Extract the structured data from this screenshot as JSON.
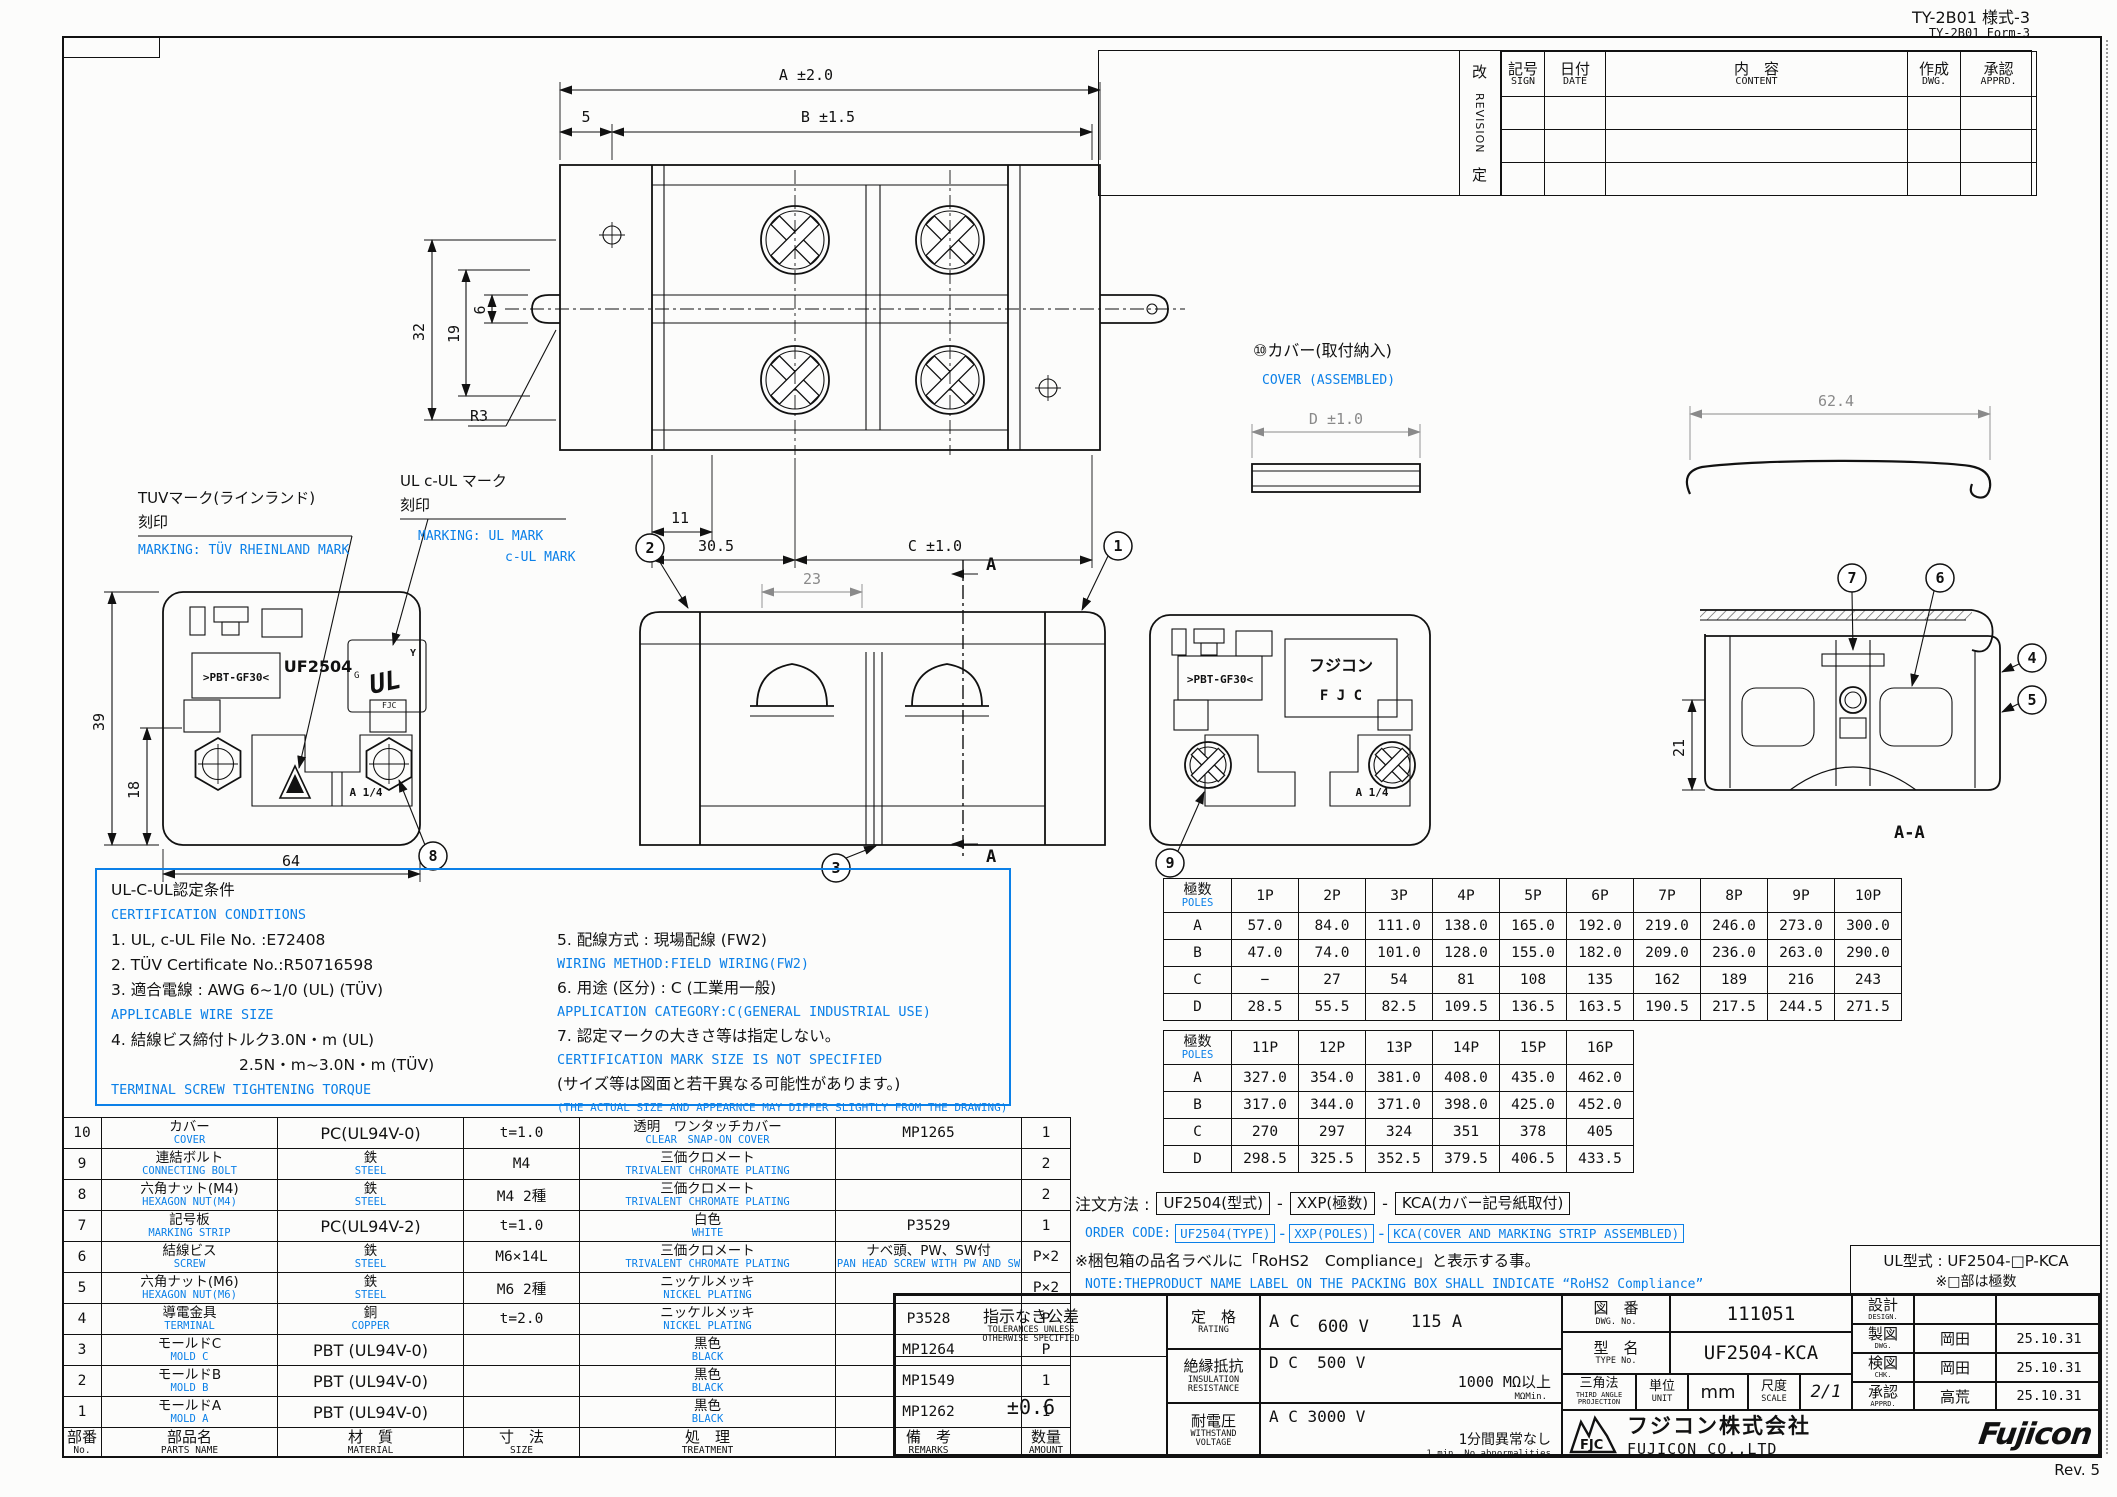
{
  "page": {
    "form_jp": "TY-2B01 様式-3",
    "form_en": "TY-2B01 Form-3",
    "rev": "Rev. 5"
  },
  "revision_table": {
    "side_top": "改",
    "side_mid": "REVISION",
    "side_bottom": "定",
    "cols": [
      {
        "jp": "記号",
        "en": "SIGN"
      },
      {
        "jp": "日付",
        "en": "DATE"
      },
      {
        "jp": "内　容",
        "en": "CONTENT"
      },
      {
        "jp": "作成",
        "en": "DWG."
      },
      {
        "jp": "承認",
        "en": "APPRD."
      }
    ],
    "empty_rows": 3
  },
  "drawing": {
    "dims": {
      "A": "A ±2.0",
      "B": "B ±1.5",
      "d5": "5",
      "d32": "32",
      "d19": "19",
      "d6": "6",
      "r3": "R3",
      "d11": "11",
      "d305": "30.5",
      "C": "C ±1.0",
      "d23": "23",
      "d39": "39",
      "d18": "18",
      "d64": "64",
      "D": "D ±1.0",
      "d624": "62.4",
      "d21": "21"
    },
    "balloons": {
      "b1": "1",
      "b2": "2",
      "b3": "3",
      "b4": "4",
      "b5": "5",
      "b6": "6",
      "b7": "7",
      "b8": "8",
      "b9": "9"
    },
    "section_arrow": "A",
    "section_label": "A-A",
    "marks": {
      "uf": "UF2504",
      "pbt": ">PBT-GF30<",
      "a14": "A 1/4",
      "brand_jp": "フジコン",
      "brand_en": "F J C",
      "ul": "UL",
      "ul_y": "Y",
      "ul_g": "G",
      "ul_fjc": "FJC"
    },
    "labels": {
      "tuv_jp1": "TUVマーク(ラインランド)",
      "tuv_jp2": "刻印",
      "tuv_en": "MARKING: TÜV RHEINLAND MARK",
      "ul_jp1": "UL c-UL マーク",
      "ul_jp2": "刻印",
      "ul_en1": "MARKING:    UL MARK",
      "ul_en2": "c-UL MARK",
      "cover_jp": "⑩カバー(取付納入)",
      "cover_en": "COVER (ASSEMBLED)"
    }
  },
  "cert_box": {
    "title": "UL-C-UL認定条件",
    "left": [
      {
        "t": "CERTIFICATION CONDITIONS",
        "blue": true
      },
      {
        "t": "1. UL, c-UL File No.   :E72408"
      },
      {
        "t": "2. TÜV Certificate No.:R50716598"
      },
      {
        "t": "3. 適合電線 : AWG  6~1/0 (UL)  (TÜV)"
      },
      {
        "t": "APPLICABLE WIRE SIZE",
        "blue": true
      },
      {
        "t": "4. 結線ビス締付トルク3.0N・m (UL)"
      },
      {
        "t": "2.5N・m~3.0N・m (TÜV)",
        "indent": true
      },
      {
        "t": "TERMINAL SCREW TIGHTENING TORQUE",
        "blue": true
      }
    ],
    "right": [
      {
        "t": "5. 配線方式 : 現場配線 (FW2)"
      },
      {
        "t": "WIRING METHOD:FIELD WIRING(FW2)",
        "blue": true
      },
      {
        "t": "6. 用途 (区分) : C (工業用一般)"
      },
      {
        "t": "APPLICATION CATEGORY:C(GENERAL INDUSTRIAL USE)",
        "blue": true
      },
      {
        "t": "7. 認定マークの大きさ等は指定しない。"
      },
      {
        "t": "CERTIFICATION MARK SIZE IS NOT SPECIFIED",
        "blue": true
      },
      {
        "t": "(サイズ等は図面と若干異なる可能性があります。)"
      },
      {
        "t": "(THE ACTUAL SIZE AND APPEARNCE MAY DIFFER SLIGHTLY FROM THE DRAWING)",
        "blue": true,
        "small": true
      }
    ]
  },
  "poles_table_1": {
    "header_jp": "極数",
    "header_en": "POLES",
    "cols": [
      "1P",
      "2P",
      "3P",
      "4P",
      "5P",
      "6P",
      "7P",
      "8P",
      "9P",
      "10P"
    ],
    "rows": [
      {
        "label": "A",
        "values": [
          "57.0",
          "84.0",
          "111.0",
          "138.0",
          "165.0",
          "192.0",
          "219.0",
          "246.0",
          "273.0",
          "300.0"
        ]
      },
      {
        "label": "B",
        "values": [
          "47.0",
          "74.0",
          "101.0",
          "128.0",
          "155.0",
          "182.0",
          "209.0",
          "236.0",
          "263.0",
          "290.0"
        ]
      },
      {
        "label": "C",
        "values": [
          "−",
          "27",
          "54",
          "81",
          "108",
          "135",
          "162",
          "189",
          "216",
          "243"
        ]
      },
      {
        "label": "D",
        "values": [
          "28.5",
          "55.5",
          "82.5",
          "109.5",
          "136.5",
          "163.5",
          "190.5",
          "217.5",
          "244.5",
          "271.5"
        ]
      }
    ]
  },
  "poles_table_2": {
    "header_jp": "極数",
    "header_en": "POLES",
    "cols": [
      "11P",
      "12P",
      "13P",
      "14P",
      "15P",
      "16P"
    ],
    "rows": [
      {
        "label": "A",
        "values": [
          "327.0",
          "354.0",
          "381.0",
          "408.0",
          "435.0",
          "462.0"
        ]
      },
      {
        "label": "B",
        "values": [
          "317.0",
          "344.0",
          "371.0",
          "398.0",
          "425.0",
          "452.0"
        ]
      },
      {
        "label": "C",
        "values": [
          "270",
          "297",
          "324",
          "351",
          "378",
          "405"
        ]
      },
      {
        "label": "D",
        "values": [
          "298.5",
          "325.5",
          "352.5",
          "379.5",
          "406.5",
          "433.5"
        ]
      }
    ]
  },
  "order_notes": {
    "jp_label": "注文方法 :",
    "jp_parts": [
      "UF2504(型式)",
      "XXP(極数)",
      "KCA(カバー記号紙取付)"
    ],
    "en_label": "ORDER CODE:",
    "en_parts": [
      "UF2504(TYPE)",
      "XXP(POLES)",
      "KCA(COVER AND MARKING STRIP ASSEMBLED)"
    ],
    "dash": "-",
    "rohs_jp": "※梱包箱の品名ラベルに「RoHS2　Compliance」と表示する事。",
    "rohs_en": "NOTE:THEPRODUCT NAME LABEL ON THE PACKING BOX SHALL INDICATE “RoHS2 Compliance”",
    "ul_type": "UL型式 : UF2504-□P-KCA",
    "ul_note": "※□部は極数"
  },
  "parts_table": {
    "headers": [
      [
        "部番",
        "No."
      ],
      [
        "部品名",
        "PARTS NAME"
      ],
      [
        "材　質",
        "MATERIAL"
      ],
      [
        "寸　法",
        "SIZE"
      ],
      [
        "処　理",
        "TREATMENT"
      ],
      [
        "備　考",
        "REMARKS"
      ],
      [
        "数量",
        "AMOUNT"
      ]
    ],
    "rows": [
      [
        "10",
        [
          "カバー",
          "COVER"
        ],
        "PC(UL94V-0)",
        "t=1.0",
        [
          "透明　ワンタッチカバー",
          "CLEAR　SNAP-ON COVER"
        ],
        "MP1265",
        "1"
      ],
      [
        "9",
        [
          "連結ボルト",
          "CONNECTING BOLT"
        ],
        [
          "鉄",
          "STEEL"
        ],
        "M4",
        [
          "三価クロメート",
          "TRIVALENT CHROMATE PLATING"
        ],
        "",
        "2"
      ],
      [
        "8",
        [
          "六角ナット(M4)",
          "HEXAGON NUT(M4)"
        ],
        [
          "鉄",
          "STEEL"
        ],
        "M4 2種",
        [
          "三価クロメート",
          "TRIVALENT CHROMATE PLATING"
        ],
        "",
        "2"
      ],
      [
        "7",
        [
          "記号板",
          "MARKING STRIP"
        ],
        "PC(UL94V-2)",
        "t=1.0",
        [
          "白色",
          "WHITE"
        ],
        "P3529",
        "1"
      ],
      [
        "6",
        [
          "結線ビス",
          "SCREW"
        ],
        [
          "鉄",
          "STEEL"
        ],
        "M6×14L",
        [
          "三価クロメート",
          "TRIVALENT CHROMATE PLATING"
        ],
        [
          "ナベ頭、PW、SW付",
          "PAN HEAD SCREW WITH PW AND SW"
        ],
        "P×2"
      ],
      [
        "5",
        [
          "六角ナット(M6)",
          "HEXAGON NUT(M6)"
        ],
        [
          "鉄",
          "STEEL"
        ],
        "M6 2種",
        [
          "ニッケルメッキ",
          "NICKEL PLATING"
        ],
        "",
        "P×2"
      ],
      [
        "4",
        [
          "導電金具",
          "TERMINAL"
        ],
        [
          "銅",
          "COPPER"
        ],
        "t=2.0",
        [
          "ニッケルメッキ",
          "NICKEL PLATING"
        ],
        "P3528",
        "P"
      ],
      [
        "3",
        [
          "モールドC",
          "MOLD C"
        ],
        "PBT (UL94V-0)",
        "",
        [
          "黒色",
          "BLACK"
        ],
        "MP1264",
        "P"
      ],
      [
        "2",
        [
          "モールドB",
          "MOLD B"
        ],
        "PBT (UL94V-0)",
        "",
        [
          "黒色",
          "BLACK"
        ],
        "MP1549",
        "1"
      ],
      [
        "1",
        [
          "モールドA",
          "MOLD A"
        ],
        "PBT (UL94V-0)",
        "",
        [
          "黒色",
          "BLACK"
        ],
        "MP1262",
        "1"
      ]
    ]
  },
  "title_block": {
    "tolerance": {
      "jp": "指示なき公差",
      "en1": "TOLERANCES UNLESS",
      "en2": "OTHERWISE SPECIFIED",
      "value": "±0.6"
    },
    "rating": {
      "jp": "定　格",
      "en": "RATING",
      "v1": "A C",
      "v2": "600 V",
      "v3": "115 A"
    },
    "insulation": {
      "jp": "絶縁抵抗",
      "en1": "INSULATION",
      "en2": "RESISTANCE",
      "v1": "D C",
      "v2": "500 V",
      "v3": "1000 MΩ以上",
      "v4": "MΩMin."
    },
    "withstand": {
      "jp": "耐電圧",
      "en1": "WITHSTAND",
      "en2": "VOLTAGE",
      "v1": "A C 3000 V",
      "v2": "1分間異常なし",
      "v3": "1 min. No abnormalities"
    },
    "dwg_no": {
      "jp": "図　番",
      "en": "DWG. No.",
      "value": "111051"
    },
    "type_no": {
      "jp": "型　名",
      "en": "TYPE No.",
      "value": "UF2504-KCA"
    },
    "projection": {
      "jp": "三角法",
      "en1": "THIRD ANGLE",
      "en2": "PROJECTION"
    },
    "unit": {
      "jp": "単位",
      "en": "UNIT",
      "value": "mm"
    },
    "scale": {
      "jp": "尺度",
      "en": "SCALE",
      "value": "2/1"
    },
    "signs": [
      {
        "jp": "設計",
        "en": "DESIGN.",
        "name": "",
        "date": ""
      },
      {
        "jp": "製図",
        "en": "DWG.",
        "name": "岡田",
        "date": "25.10.31"
      },
      {
        "jp": "検図",
        "en": "CHK.",
        "name": "岡田",
        "date": "25.10.31"
      },
      {
        "jp": "承認",
        "en": "APPRD.",
        "name": "高荒",
        "date": "25.10.31"
      }
    ],
    "company": {
      "logo_text": "FJC",
      "jp": "フジコン株式会社",
      "en": "FUJICON CO.,LTD",
      "brand": "Fujicon"
    }
  }
}
